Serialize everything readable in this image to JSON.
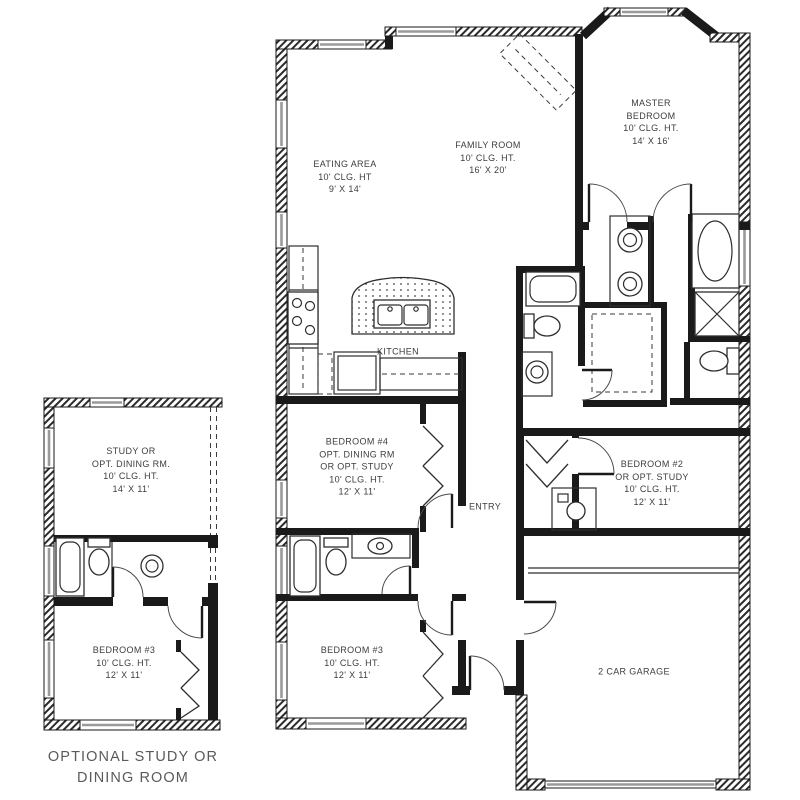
{
  "figure": {
    "kind": "architectural-floor-plan"
  },
  "colors": {
    "background": "#ffffff",
    "wall": "#1a1a1a",
    "line": "#2e2e2e",
    "window": "#9a9a9a",
    "label_text": "#3d3d3d",
    "caption_text": "#5a5a5a"
  },
  "main_plan": {
    "rooms": {
      "eating_area": {
        "label": "EATING AREA\n10' CLG. HT\n9' X 14'"
      },
      "family_room": {
        "label": "FAMILY ROOM\n10' CLG. HT.\n16' X 20'"
      },
      "master_bedroom": {
        "label": "MASTER\nBEDROOM\n10' CLG. HT.\n14' X 16'"
      },
      "kitchen": {
        "label": "KITCHEN"
      },
      "bedroom_4": {
        "label": "BEDROOM #4\nOPT. DINING RM\nOR OPT. STUDY\n10' CLG. HT.\n12' X 11'"
      },
      "entry": {
        "label": "ENTRY"
      },
      "bedroom_2": {
        "label": "BEDROOM #2\nOR OPT. STUDY\n10' CLG. HT.\n12' X 11'"
      },
      "bedroom_3": {
        "label": "BEDROOM #3\n10' CLG. HT.\n12' X 11'"
      },
      "garage": {
        "label": "2 CAR GARAGE"
      }
    }
  },
  "optional_plan": {
    "rooms": {
      "study": {
        "label": "STUDY OR\nOPT. DINING RM.\n10' CLG. HT.\n14' X 11'"
      },
      "bedroom_3": {
        "label": "BEDROOM #3\n10' CLG. HT.\n12' X 11'"
      }
    },
    "caption": "OPTIONAL STUDY OR\nDINING ROOM"
  }
}
